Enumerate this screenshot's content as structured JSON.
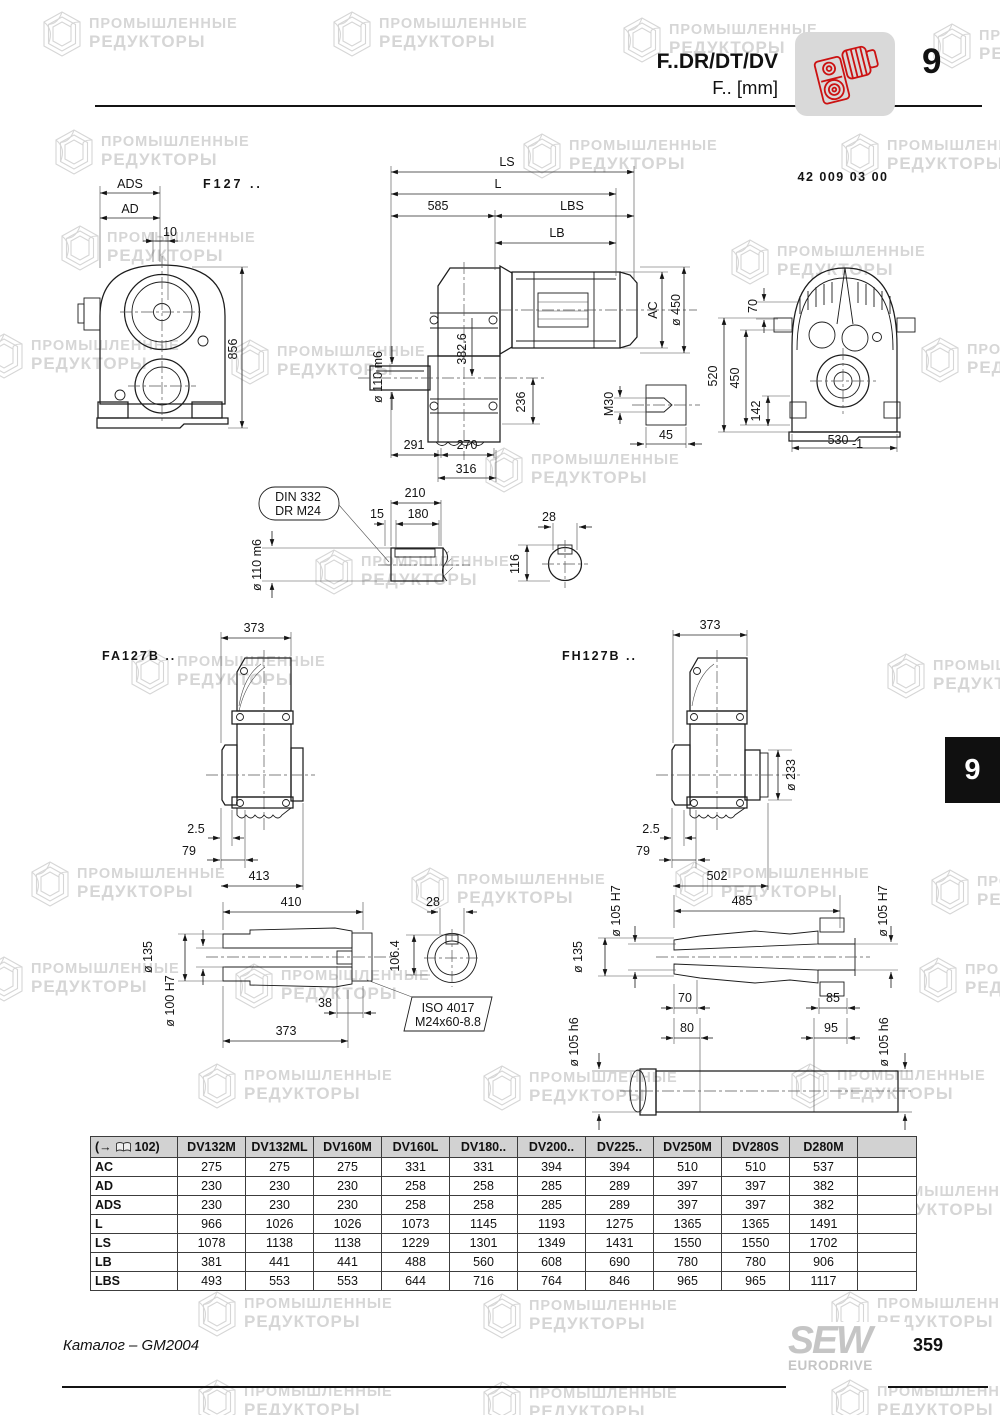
{
  "header": {
    "model": "F..DR/DT/DV",
    "unit": "F.. [mm]",
    "chapter": "9"
  },
  "side_tab": {
    "number": "9"
  },
  "watermark": {
    "line1": "ПРОМЫШЛЕННЫЕ",
    "line2": "РЕДУКТОРЫ"
  },
  "drawings": {
    "f127": {
      "title": "F127 ..",
      "part_number": "42 009 03 00",
      "front": {
        "ads": "ADS",
        "ad": "AD",
        "offset10": "10",
        "h856": "856"
      },
      "side": {
        "ls": "LS",
        "l": "L",
        "d585": "585",
        "lbs": "LBS",
        "lb": "LB",
        "ac": "AC",
        "dia450": "ø 450",
        "d382": "382.6",
        "d236": "236",
        "dia110": "ø 110 m6",
        "m30": "M30",
        "d45": "45",
        "d291": "291",
        "d270": "270",
        "d316": "316"
      },
      "end": {
        "d70": "70",
        "d520": "520",
        "d450": "450",
        "d142": "142",
        "d530": "530",
        "tol": "-1"
      },
      "shaft": {
        "callout_line1": "DIN 332",
        "callout_line2": "DR M24",
        "d210": "210",
        "d15": "15",
        "d180": "180",
        "dia110": "ø 110 m6",
        "d28": "28",
        "d116": "116"
      }
    },
    "fa127b": {
      "title": "FA127B ..",
      "d373": "373",
      "d2_5": "2.5",
      "d79": "79",
      "d413": "413",
      "hollow": {
        "d410": "410",
        "dia135": "ø 135",
        "dia100": "ø 100 H7",
        "d38": "38",
        "d373": "373",
        "d28": "28",
        "d106": "106.4",
        "callout_line1": "ISO 4017",
        "callout_line2": "M24x60-8.8"
      }
    },
    "fh127b": {
      "title": "FH127B ..",
      "d373": "373",
      "dia233": "ø 233",
      "d2_5": "2.5",
      "d79": "79",
      "d502": "502",
      "hollow": {
        "d485": "485",
        "dia105h7": "ø 105 H7",
        "dia135": "ø 135",
        "d70": "70",
        "d85": "85",
        "d80": "80",
        "d95": "95",
        "dia105h6": "ø 105 h6"
      }
    }
  },
  "table": {
    "ref_prefix": "(→",
    "ref_suffix": "102)",
    "columns": [
      "DV132M",
      "DV132ML",
      "DV160M",
      "DV160L",
      "DV180..",
      "DV200..",
      "DV225..",
      "DV250M",
      "DV280S",
      "D280M"
    ],
    "rows": [
      {
        "label": "AC",
        "values": [
          "275",
          "275",
          "275",
          "331",
          "331",
          "394",
          "394",
          "510",
          "510",
          "537"
        ]
      },
      {
        "label": "AD",
        "values": [
          "230",
          "230",
          "230",
          "258",
          "258",
          "285",
          "289",
          "397",
          "397",
          "382"
        ]
      },
      {
        "label": "ADS",
        "values": [
          "230",
          "230",
          "230",
          "258",
          "258",
          "285",
          "289",
          "397",
          "397",
          "382"
        ]
      },
      {
        "label": "L",
        "values": [
          "966",
          "1026",
          "1026",
          "1073",
          "1145",
          "1193",
          "1275",
          "1365",
          "1365",
          "1491"
        ]
      },
      {
        "label": "LS",
        "values": [
          "1078",
          "1138",
          "1138",
          "1229",
          "1301",
          "1349",
          "1431",
          "1550",
          "1550",
          "1702"
        ]
      },
      {
        "label": "LB",
        "values": [
          "381",
          "441",
          "441",
          "488",
          "560",
          "608",
          "690",
          "780",
          "780",
          "906"
        ]
      },
      {
        "label": "LBS",
        "values": [
          "493",
          "553",
          "553",
          "644",
          "716",
          "764",
          "846",
          "965",
          "965",
          "1117"
        ]
      }
    ]
  },
  "footer": {
    "catalog": "Каталог – GM2004",
    "page": "359",
    "logo_line1": "SEW",
    "logo_line2": "EURODRIVE"
  }
}
